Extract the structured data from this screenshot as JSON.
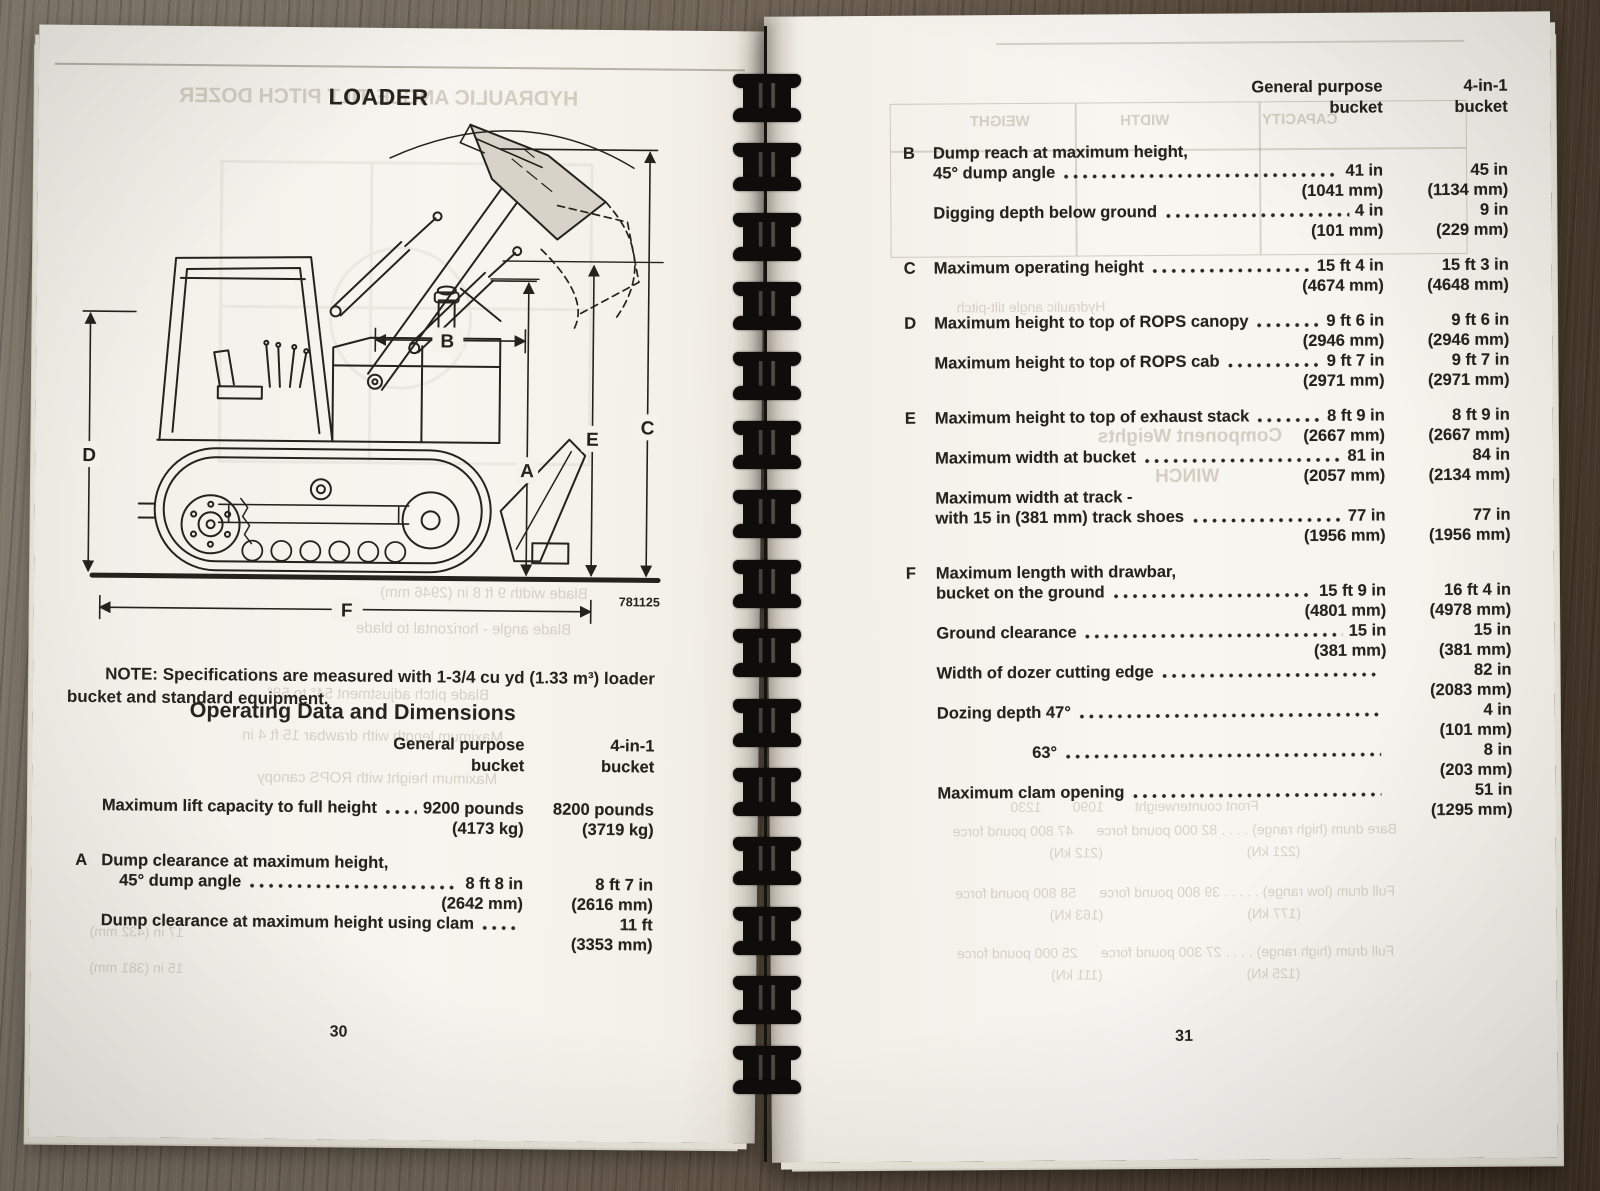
{
  "left_page": {
    "title": "LOADER",
    "figure_number": "781125",
    "diagram_labels": {
      "a": "A",
      "b": "B",
      "c": "C",
      "d": "D",
      "e": "E",
      "f": "F"
    },
    "note_label": "NOTE:",
    "note_text": "Specifications are measured with 1-3/4 cu yd (1.33 m³) loader bucket and standard equipment.",
    "section_heading": "Operating Data and Dimensions",
    "columns": {
      "gp": [
        "General purpose",
        "bucket"
      ],
      "f41": [
        "4-in-1",
        "bucket"
      ]
    },
    "rows": [
      {
        "label": "Maximum lift capacity to full height",
        "leader": true,
        "gp": "9200 pounds",
        "f41": "8200 pounds"
      },
      {
        "gp": "(4173 kg)",
        "f41": "(3719 kg)"
      },
      {
        "gap": true
      },
      {
        "letter": "A",
        "label": "Dump clearance at maximum height,"
      },
      {
        "label": "45° dump angle",
        "indent": 1,
        "leader": true,
        "gp": "8 ft 8 in",
        "f41": "8 ft 7 in"
      },
      {
        "gp": "(2642 mm)",
        "f41": "(2616 mm)"
      },
      {
        "label": "Dump clearance at maximum height using clam",
        "leader": true,
        "f41": "11 ft"
      },
      {
        "f41": "(3353 mm)"
      }
    ],
    "page_number": "30",
    "ghosts": [
      {
        "text": "HYDRAULIC ANGLE TILT PITCH DOZER",
        "x": 60,
        "y": 58,
        "w": 560,
        "size": 21,
        "bold": true
      },
      {
        "text": "Blade width 9 ft 8 in (2946 mm)",
        "x": 240,
        "y": 556,
        "w": 420,
        "size": 15
      },
      {
        "text": "Blade angle - horizontal to blade",
        "x": 220,
        "y": 592,
        "w": 420,
        "size": 15
      },
      {
        "text": "Blade pitch adjustment 54° to 58°",
        "x": 110,
        "y": 658,
        "w": 470,
        "size": 15
      },
      {
        "text": "Maximum length with drawbar 15 ft 4 in",
        "x": 90,
        "y": 700,
        "w": 500,
        "size": 15
      },
      {
        "text": "Maximum height with ROPS canopy",
        "x": 110,
        "y": 742,
        "w": 470,
        "size": 15
      },
      {
        "text": "17 in (432 mm)",
        "x": 6,
        "y": 898,
        "w": 200,
        "size": 14
      },
      {
        "text": "15 in (381 mm)",
        "x": 6,
        "y": 934,
        "w": 200,
        "size": 14
      }
    ]
  },
  "right_page": {
    "columns": {
      "gp": [
        "General purpose",
        "bucket"
      ],
      "f41": [
        "4-in-1",
        "bucket"
      ]
    },
    "rows": [
      {
        "letter": "B",
        "label": "Dump reach at maximum height,"
      },
      {
        "label": "45° dump angle",
        "leader": true,
        "gp": "41 in",
        "f41": "45 in"
      },
      {
        "gp": "(1041 mm)",
        "f41": "(1134 mm)"
      },
      {
        "label": "Digging depth below ground",
        "leader": true,
        "gp": "4 in",
        "f41": "9 in"
      },
      {
        "gp": "(101 mm)",
        "f41": "(229 mm)"
      },
      {
        "gap": true
      },
      {
        "letter": "C",
        "label": "Maximum operating height",
        "leader": true,
        "gp": "15 ft 4 in",
        "f41": "15 ft 3 in"
      },
      {
        "gp": "(4674 mm)",
        "f41": "(4648 mm)"
      },
      {
        "gap": true
      },
      {
        "letter": "D",
        "label": "Maximum height to top of ROPS canopy",
        "leader": true,
        "gp": "9 ft 6 in",
        "f41": "9 ft 6 in"
      },
      {
        "gp": "(2946 mm)",
        "f41": "(2946 mm)"
      },
      {
        "label": "Maximum height to top of ROPS cab",
        "leader": true,
        "gp": "9 ft 7 in",
        "f41": "9 ft 7 in"
      },
      {
        "gp": "(2971 mm)",
        "f41": "(2971 mm)"
      },
      {
        "gap": true
      },
      {
        "letter": "E",
        "label": "Maximum height to top of exhaust stack",
        "leader": true,
        "gp": "8 ft 9 in",
        "f41": "8 ft 9 in"
      },
      {
        "gp": "(2667 mm)",
        "f41": "(2667 mm)"
      },
      {
        "label": "Maximum width at bucket",
        "leader": true,
        "gp": "81 in",
        "f41": "84 in"
      },
      {
        "gp": "(2057 mm)",
        "f41": "(2134 mm)"
      },
      {
        "label": "Maximum width at track -"
      },
      {
        "label": "with 15 in (381 mm) track shoes",
        "leader": true,
        "gp": "77 in",
        "f41": "77 in"
      },
      {
        "gp": "(1956 mm)",
        "f41": "(1956 mm)"
      },
      {
        "gap": true
      },
      {
        "letter": "F",
        "label": "Maximum length with drawbar,"
      },
      {
        "label": "bucket on the ground",
        "leader": true,
        "gp": "15 ft 9 in",
        "f41": "16 ft 4 in"
      },
      {
        "gp": "(4801 mm)",
        "f41": "(4978 mm)"
      },
      {
        "label": "Ground clearance",
        "leader": true,
        "gp": "15 in",
        "f41": "15 in"
      },
      {
        "gp": "(381 mm)",
        "f41": "(381 mm)"
      },
      {
        "label": "Width of dozer cutting edge",
        "leader": true,
        "f41": "82 in"
      },
      {
        "f41": "(2083 mm)"
      },
      {
        "label": "Dozing depth 47°",
        "leader": true,
        "f41": "4 in"
      },
      {
        "f41": "(101 mm)"
      },
      {
        "label": "63°",
        "indent": 2,
        "leader": true,
        "f41": "8 in"
      },
      {
        "f41": "(203 mm)"
      },
      {
        "label": "Maximum clam opening",
        "leader": true,
        "f41": "51 in"
      },
      {
        "f41": "(1295 mm)"
      }
    ],
    "page_number": "31",
    "ghosts": [
      {
        "text": "WEIGHT",
        "x": 170,
        "y": 98,
        "w": 130,
        "size": 15,
        "bold": true
      },
      {
        "text": "WIDTH",
        "x": 320,
        "y": 98,
        "w": 120,
        "size": 15,
        "bold": true
      },
      {
        "text": "CAPACITY",
        "x": 460,
        "y": 98,
        "w": 150,
        "size": 15,
        "bold": true
      },
      {
        "text": "Hydraulic angle tilt-pitch",
        "x": 130,
        "y": 284,
        "w": 270,
        "size": 14
      },
      {
        "text": "Component Weights",
        "x": 288,
        "y": 412,
        "w": 270,
        "size": 19,
        "bold": true
      },
      {
        "text": "WINCH",
        "x": 330,
        "y": 452,
        "w": 180,
        "size": 19,
        "bold": true
      },
      {
        "text": "Front counterweight        1090        1230",
        "x": 150,
        "y": 784,
        "w": 430,
        "size": 14
      },
      {
        "text": "Bare drum (high range) . . . . 82 000 pound force      47 800 pound force",
        "x": 140,
        "y": 808,
        "w": 530,
        "size": 14
      },
      {
        "text": "(221 kN)                                     (212 kN)",
        "x": 140,
        "y": 830,
        "w": 530,
        "size": 14
      },
      {
        "text": "Full drum (low range) . . . . . 39 800 pound force      58 800 pound force",
        "x": 140,
        "y": 870,
        "w": 530,
        "size": 14
      },
      {
        "text": "(177 kN)                                     (163 kN)",
        "x": 140,
        "y": 892,
        "w": 530,
        "size": 14
      },
      {
        "text": "Full drum (high range) . . . . 27 300 pound force      25 000 pound force",
        "x": 140,
        "y": 930,
        "w": 530,
        "size": 14
      },
      {
        "text": "(125 kN)                                     (111 kN)",
        "x": 140,
        "y": 952,
        "w": 530,
        "size": 14
      }
    ]
  }
}
